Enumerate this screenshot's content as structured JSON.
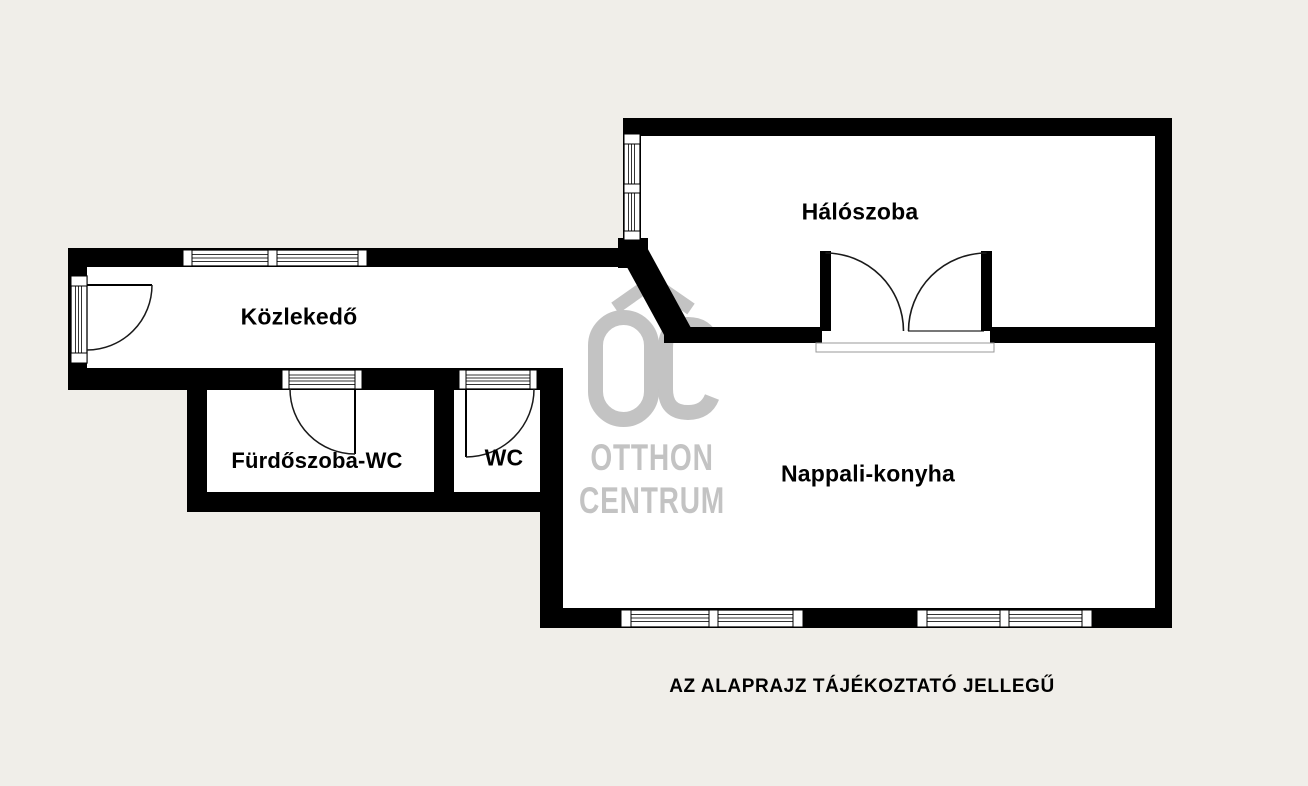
{
  "plan": {
    "rooms": [
      {
        "id": "haloszoba",
        "label": "Hálószoba"
      },
      {
        "id": "kozlekedo",
        "label": "Közlekedő"
      },
      {
        "id": "furdoszoba-wc",
        "label": "Fürdőszoba-WC"
      },
      {
        "id": "wc",
        "label": "WC"
      },
      {
        "id": "nappali-konyha",
        "label": "Nappali-konyha"
      }
    ],
    "caption": "AZ ALAPRAJZ TÁJÉKOZTATÓ JELLEGŰ"
  },
  "watermark": {
    "logo_text": "OC",
    "line1": "OTTHON",
    "line2": "CENTRUM"
  },
  "colors": {
    "background": "#f0eee9",
    "floor": "#ffffff",
    "wall": "#000000",
    "watermark": "#c3c3c3",
    "text": "#000000"
  }
}
